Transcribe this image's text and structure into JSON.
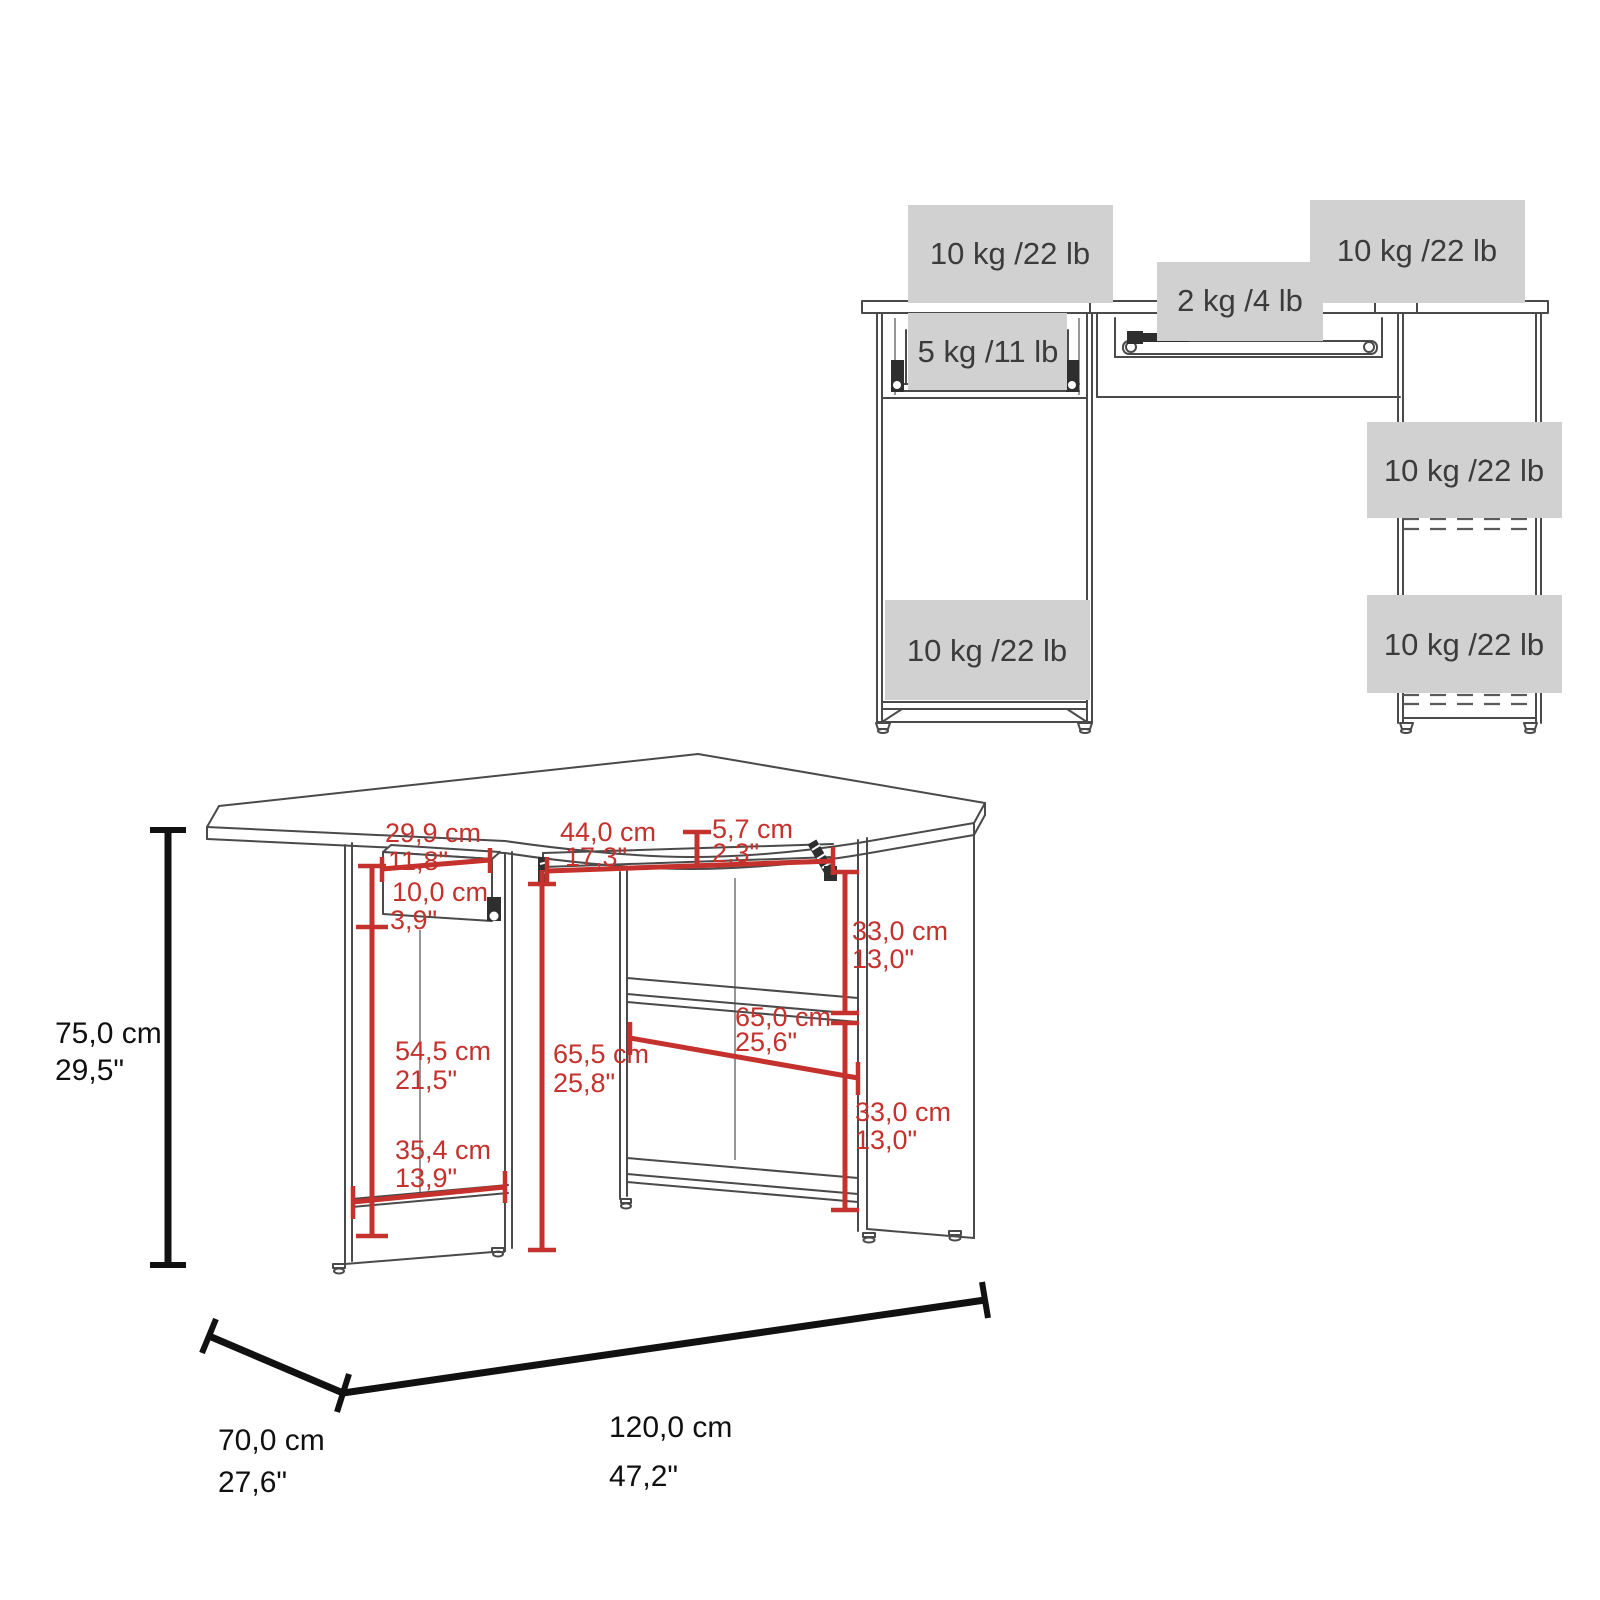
{
  "sheet": {
    "type": "furniture-dimension-diagram",
    "product": "corner computer desk"
  },
  "colors": {
    "dimension_red": "#c5312c",
    "label_box_gray": "#d1d1d1",
    "line_color": "#4a4a4a",
    "text_dark": "#3b3b3b",
    "overall_dim_black": "#111111"
  },
  "weight_view": {
    "labels": {
      "desk_top_left": "10 kg /22 lb",
      "desk_top_right": "10 kg /22 lb",
      "keyboard_tray_left": "5 kg /11 lb",
      "keyboard_tray_center": "2 kg /4 lb",
      "right_shelf_upper": "10 kg /22 lb",
      "pedestal_bottom_shelf": "10 kg /22 lb",
      "right_shelf_lower": "10 kg /22 lb"
    }
  },
  "dimension_view": {
    "overall_height": {
      "cm": "75,0 cm",
      "in": "29,5\""
    },
    "overall_depth": {
      "cm": "70,0 cm",
      "in": "27,6\""
    },
    "overall_width": {
      "cm": "120,0 cm",
      "in": "47,2\""
    },
    "drawer_width": {
      "cm": "29,9 cm",
      "in": "11,8\""
    },
    "drawer_height": {
      "cm": "10,0 cm",
      "in": "3,9\""
    },
    "keyboard_shelf_width": {
      "cm": "44,0 cm",
      "in": "17,3\""
    },
    "top_edge_height": {
      "cm": "5,7 cm",
      "in": "2,3\""
    },
    "right_shelf_gap_upper": {
      "cm": "33,0 cm",
      "in": "13,0\""
    },
    "right_shelf_width": {
      "cm": "65,0 cm",
      "in": "25,6\""
    },
    "left_compartment_height": {
      "cm": "54,5 cm",
      "in": "21,5\""
    },
    "center_clearance_height": {
      "cm": "65,5 cm",
      "in": "25,8\""
    },
    "right_shelf_gap_lower": {
      "cm": "33,0 cm",
      "in": "13,0\""
    },
    "left_compartment_width": {
      "cm": "35,4 cm",
      "in": "13,9\""
    }
  }
}
